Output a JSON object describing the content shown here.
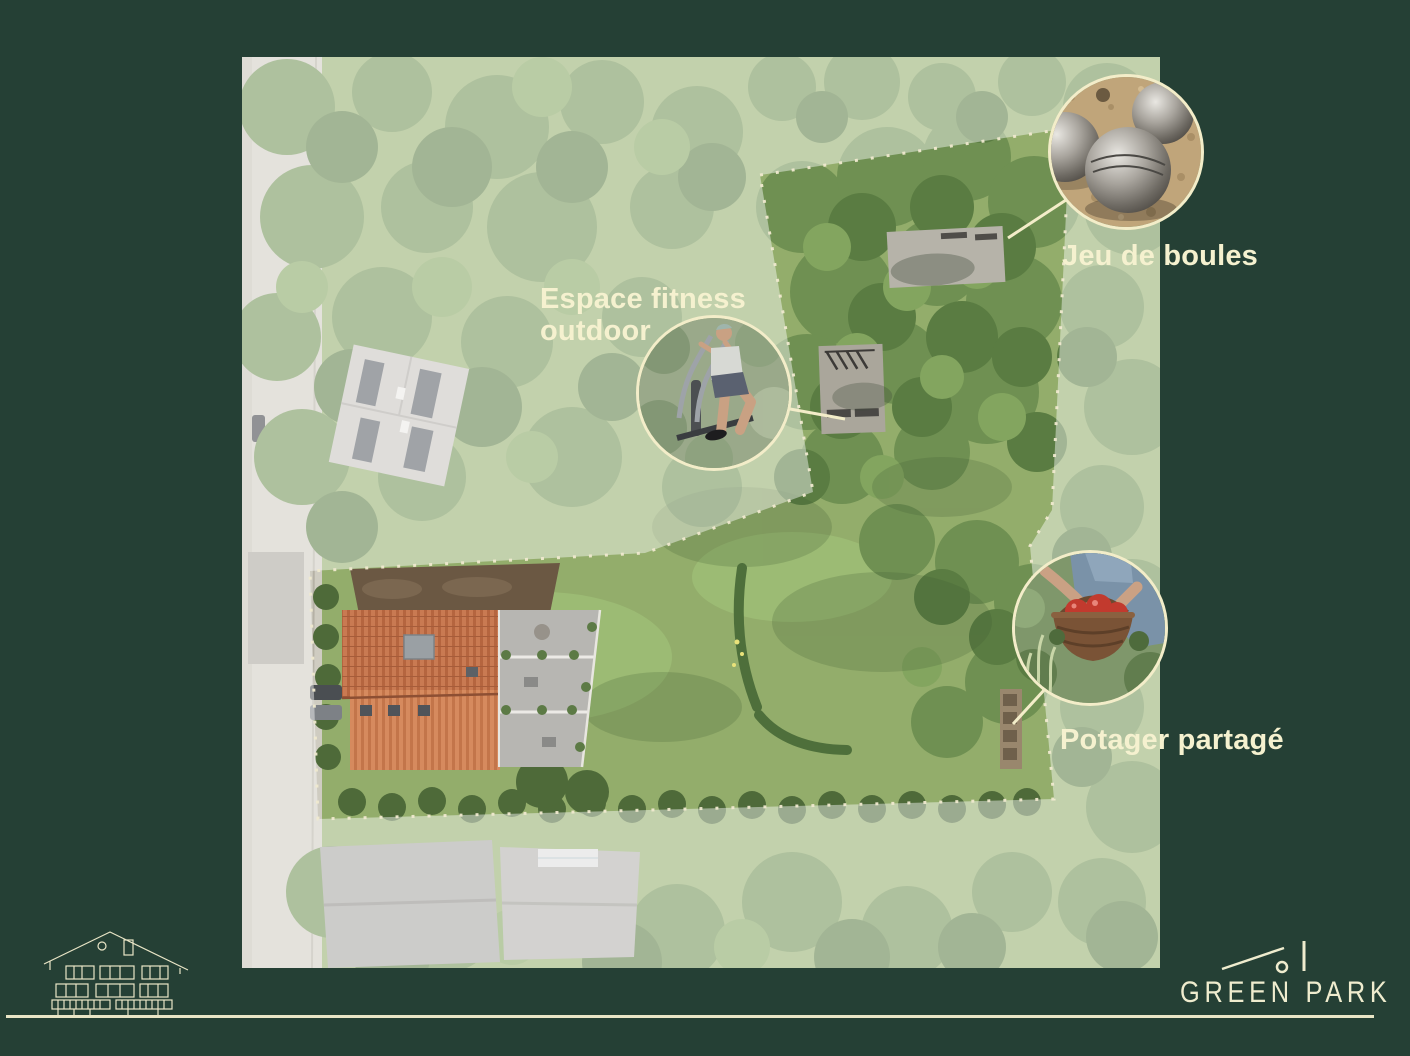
{
  "slide": {
    "background_color": "#254035",
    "accent_cream": "#f2eecd"
  },
  "annotations": {
    "fitness": {
      "line1": "Espace fitness",
      "line2": "outdoor"
    },
    "boules": {
      "label": "Jeu de boules"
    },
    "potager": {
      "label": "Potager partagé"
    }
  },
  "brand": {
    "wordmark": "GREEN PARK"
  },
  "icons": {
    "boules_callout": "petanque-balls-photo",
    "fitness_callout": "outdoor-elliptical-photo",
    "potager_callout": "vegetable-basket-photo",
    "footer_left": "chalet-elevation-drawing",
    "brand_mark": "roofline-logo-mark"
  }
}
